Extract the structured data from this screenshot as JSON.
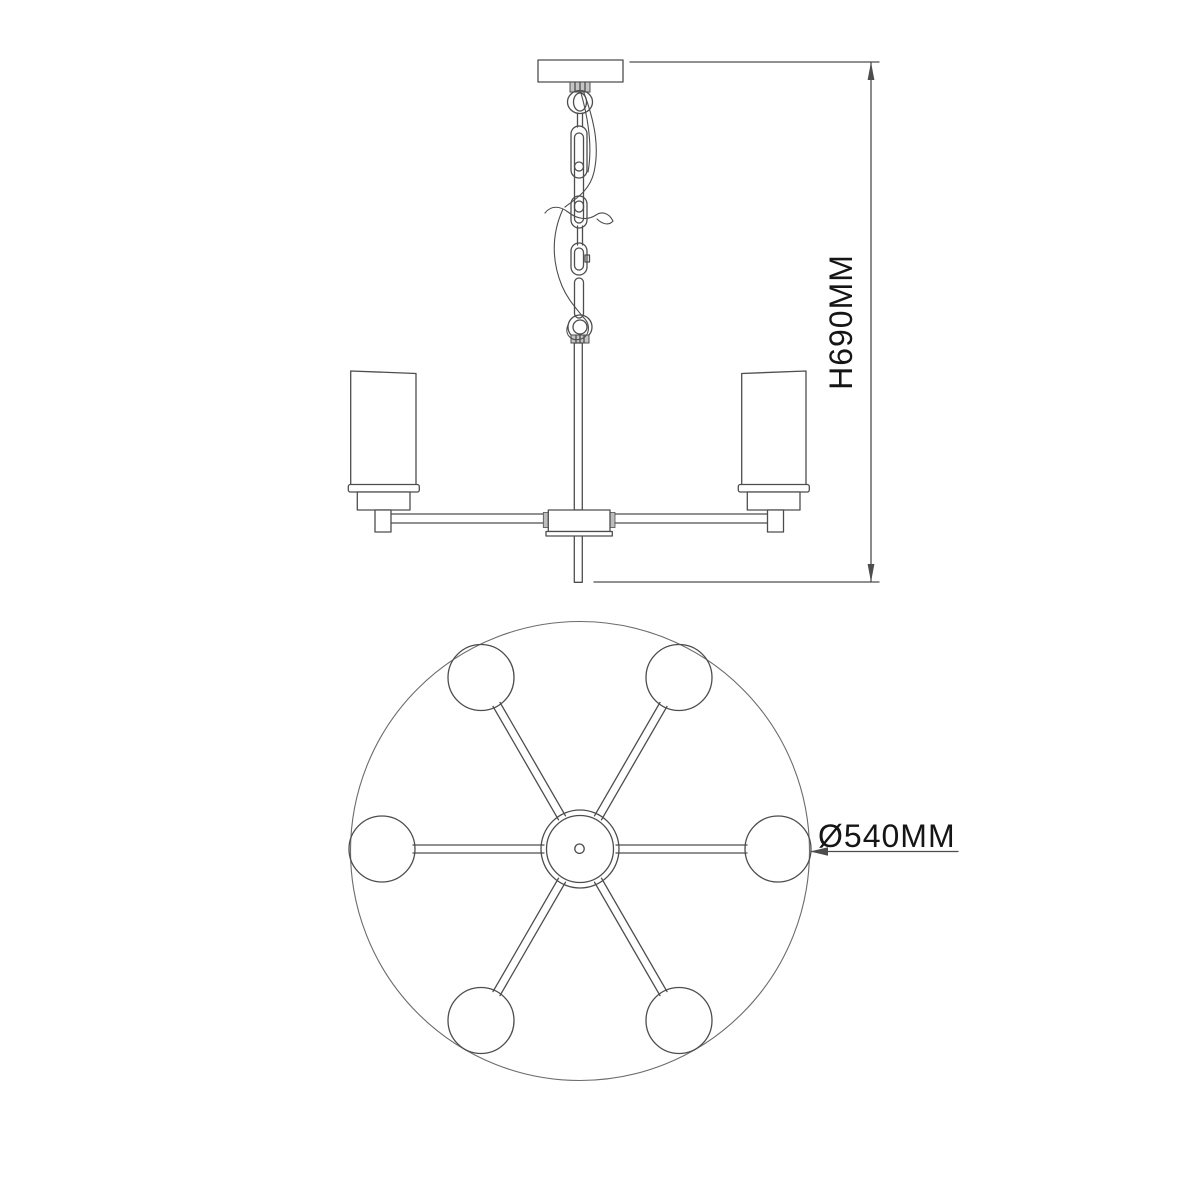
{
  "drawing": {
    "kind": "chandelier dimension diagram",
    "views": {
      "top": "side elevation",
      "bottom": "plan view"
    }
  },
  "dimensions": {
    "height": {
      "label": "H690MM",
      "value_mm": 690,
      "orientation": "vertical"
    },
    "diameter": {
      "label": "Ø540MM",
      "value_mm": 540,
      "orientation": "horizontal"
    }
  },
  "fixture": {
    "plan_view_shade_count": 6,
    "side_view_shade_count": 2,
    "shade_shape": "cylinder"
  },
  "colors": {
    "background": "#ffffff",
    "line": "#4d4d4d",
    "line_light": "#6b6b6b",
    "text": "#151515"
  }
}
